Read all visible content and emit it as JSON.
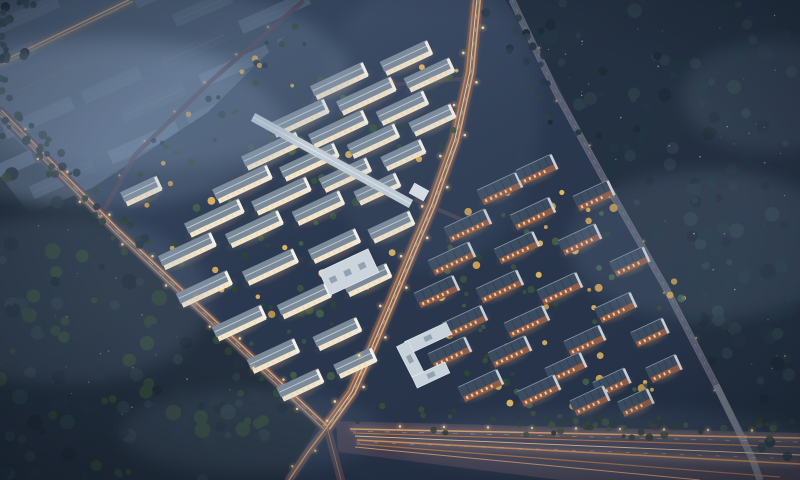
{
  "meta": {
    "title": "Night aerial rendering of residential development",
    "kind": "architectural-visualization",
    "width": 800,
    "height": 480
  },
  "colors": {
    "baseTL": "#41536c",
    "baseMid": "#2b3950",
    "baseBR": "#232e42",
    "forest1": "#263642",
    "forest2": "#1e2b37",
    "forest3": "#2d3e49",
    "forest4": "#223440",
    "forestGreen": "#2f4438",
    "indA": "#46586f",
    "indB": "#3e4e63",
    "indC": "#4e6078",
    "roadSurface": "#4c4859",
    "roadSurfaceWide": "#474354",
    "roadEdge": "#5e5a6d",
    "trailOrange": "#f2a96b",
    "trailBright": "#ffd8a4",
    "trailDeep": "#cf8349",
    "dashWhite": "#ded8cc",
    "lampCore": "#ffe2ad",
    "lampHalo": "#f5b878",
    "whiteRoof": "#7b8a99",
    "whiteRidge": "#c2cdd6",
    "whiteFacade": "#efe7d6",
    "whiteWindow": "#ffd9a0",
    "whiteEnd": "#f6f1e6",
    "darkRoof": "#3c4c60",
    "darkPanel": "#2e3c4e",
    "darkRidge": "#8494a4",
    "brick": "#8e5c48",
    "brickWindow": "#ffc890",
    "gable": "#d8dee3",
    "corridorRoof": "#c3ced7",
    "flatRoof": "#ccd5dd",
    "skylight": "#91a2b0",
    "glow": "#ffbe78",
    "fog": "#8aa0bc",
    "sparkle": "#cfd9e4",
    "treeYellow": "#d2a24f",
    "treeYellow2": "#e2b660",
    "clusterGreen": "#3a5440"
  },
  "industrial": {
    "clip": [
      [
        24,
        0
      ],
      [
        322,
        0
      ],
      [
        208,
        112
      ],
      [
        92,
        188
      ],
      [
        30,
        214
      ],
      [
        0,
        176
      ],
      [
        0,
        30
      ]
    ],
    "rotation": -24,
    "pivot": [
      150,
      80
    ],
    "rows": 8,
    "cols": 8,
    "x0": -90,
    "y0": -70,
    "dx": 86,
    "dy": 33,
    "w": 62,
    "h": 14,
    "opacity": 0.92,
    "fogPatch": [
      95,
      120,
      200,
      85,
      0.3
    ]
  },
  "roads": {
    "leftRoad": {
      "pts": [
        [
          0,
          112
        ],
        [
          118,
          232
        ],
        [
          325,
          427
        ]
      ],
      "w": 9
    },
    "mainRoad": {
      "pts": [
        [
          477,
          0
        ],
        [
          470,
          72
        ],
        [
          455,
          140
        ],
        [
          432,
          205
        ],
        [
          412,
          252
        ],
        [
          392,
          300
        ],
        [
          370,
          352
        ],
        [
          352,
          392
        ],
        [
          327,
          427
        ]
      ],
      "w": 13
    },
    "exitS": {
      "pts": [
        [
          327,
          427
        ],
        [
          341,
          480
        ]
      ],
      "w": 8
    },
    "exitSW": {
      "pts": [
        [
          327,
          427
        ],
        [
          308,
          452
        ],
        [
          289,
          480
        ]
      ],
      "w": 8
    },
    "rightRoad": {
      "pts": [
        [
          512,
          0
        ],
        [
          556,
          92
        ],
        [
          610,
          190
        ],
        [
          667,
          290
        ],
        [
          716,
          385
        ],
        [
          752,
          458
        ],
        [
          760,
          480
        ]
      ],
      "w": 5.5
    },
    "edgeRoad": {
      "pts": [
        [
          302,
          2
        ],
        [
          212,
          80
        ],
        [
          135,
          155
        ],
        [
          103,
          212
        ],
        [
          118,
          232
        ]
      ],
      "w": 4.5
    },
    "northEntry": {
      "pts": [
        [
          472,
          78
        ],
        [
          386,
          85
        ]
      ],
      "w": 4
    },
    "gateRoad": {
      "pts": [
        [
          416,
          200
        ],
        [
          467,
          222
        ]
      ],
      "w": 4
    },
    "cornerTrail": {
      "pts": [
        [
          0,
          64
        ],
        [
          132,
          0
        ]
      ],
      "w": 3
    },
    "bottomPoly": [
      [
        336,
        421
      ],
      [
        800,
        433
      ],
      [
        800,
        480
      ],
      [
        560,
        480
      ],
      [
        338,
        452
      ]
    ],
    "bottomLanes": [
      {
        "a": [
          350,
          429
        ],
        "b": [
          800,
          438
        ],
        "c": "#f2ab6e",
        "w": 1.5,
        "glow": true
      },
      {
        "a": [
          353,
          433
        ],
        "b": [
          800,
          447
        ],
        "c": "#cc8148",
        "w": 1.1
      },
      {
        "a": [
          355,
          436
        ],
        "b": [
          800,
          455
        ],
        "c": "#ffd8a4",
        "w": 0.9
      },
      {
        "a": [
          357,
          440
        ],
        "b": [
          800,
          464
        ],
        "c": "#e89a5c",
        "w": 1.5,
        "glow": true
      },
      {
        "a": [
          357,
          444
        ],
        "b": [
          780,
          477
        ],
        "c": "#c07a45",
        "w": 1.2
      },
      {
        "a": [
          355,
          447
        ],
        "b": [
          700,
          480
        ],
        "c": "#e8a76a",
        "w": 1.0
      },
      {
        "a": [
          351,
          431
        ],
        "b": [
          800,
          442
        ],
        "c": "#ded8cc",
        "w": 0.6,
        "dash": "5 12"
      },
      {
        "a": [
          356,
          442
        ],
        "b": [
          800,
          459
        ],
        "c": "#d8d2c6",
        "w": 0.6,
        "dash": "4 14"
      }
    ]
  },
  "clusters": {
    "left": {
      "angle": -25,
      "buildings": [
        [
          340,
          82,
          58
        ],
        [
          407,
          59,
          52
        ],
        [
          300,
          119,
          60
        ],
        [
          367,
          97,
          60
        ],
        [
          430,
          76,
          50
        ],
        [
          272,
          152,
          60
        ],
        [
          339,
          130,
          60
        ],
        [
          403,
          109,
          52
        ],
        [
          243,
          185,
          60
        ],
        [
          310,
          163,
          60
        ],
        [
          374,
          142,
          52
        ],
        [
          433,
          121,
          46
        ],
        [
          215,
          219,
          60
        ],
        [
          282,
          197,
          60
        ],
        [
          346,
          176,
          52
        ],
        [
          404,
          156,
          44
        ],
        [
          188,
          252,
          58
        ],
        [
          255,
          230,
          58
        ],
        [
          319,
          209,
          52
        ],
        [
          378,
          190,
          46
        ],
        [
          205,
          290,
          56
        ],
        [
          271,
          268,
          56
        ],
        [
          335,
          247,
          52
        ],
        [
          392,
          228,
          46
        ],
        [
          240,
          324,
          54
        ],
        [
          305,
          302,
          54
        ],
        [
          368,
          281,
          48
        ],
        [
          274,
          357,
          52
        ],
        [
          338,
          335,
          48
        ],
        [
          301,
          386,
          46
        ],
        [
          356,
          364,
          42
        ],
        [
          142,
          192,
          40
        ],
        [
          152,
          197,
          0
        ]
      ]
    },
    "right": {
      "angle": -25,
      "buildings": [
        [
          500,
          189,
          44
        ],
        [
          537,
          170,
          40
        ],
        [
          468,
          226,
          46
        ],
        [
          533,
          214,
          44
        ],
        [
          594,
          196,
          40
        ],
        [
          452,
          259,
          46
        ],
        [
          517,
          248,
          44
        ],
        [
          580,
          240,
          42
        ],
        [
          630,
          262,
          38
        ],
        [
          437,
          292,
          44
        ],
        [
          500,
          287,
          46
        ],
        [
          560,
          289,
          44
        ],
        [
          616,
          308,
          40
        ],
        [
          650,
          333,
          36
        ],
        [
          465,
          322,
          44
        ],
        [
          527,
          322,
          44
        ],
        [
          585,
          341,
          40
        ],
        [
          664,
          369,
          34
        ],
        [
          450,
          353,
          42
        ],
        [
          510,
          352,
          42
        ],
        [
          566,
          368,
          40
        ],
        [
          612,
          383,
          36
        ],
        [
          481,
          386,
          44
        ],
        [
          539,
          391,
          42
        ],
        [
          590,
          401,
          38
        ],
        [
          636,
          403,
          34
        ]
      ]
    },
    "corridor": {
      "a": [
        253,
        117
      ],
      "b": [
        411,
        204
      ],
      "w": 9
    },
    "gate": {
      "cx": 419,
      "cy": 192,
      "w": 17,
      "h": 12,
      "rot": 29
    },
    "bigFlat": {
      "cx": 349,
      "cy": 272,
      "w": 54,
      "h": 26,
      "rot": -25
    },
    "uBuilding": [
      {
        "cx": 428,
        "cy": 338,
        "w": 46,
        "h": 13,
        "rot": -25
      },
      {
        "cx": 410,
        "cy": 359,
        "w": 34,
        "h": 13,
        "rot": 63
      },
      {
        "cx": 431,
        "cy": 375,
        "w": 36,
        "h": 12,
        "rot": -25
      }
    ]
  },
  "forests": [
    {
      "name": "top-right",
      "poly": [
        [
          505,
          0
        ],
        [
          800,
          0
        ],
        [
          800,
          468
        ],
        [
          772,
          468
        ],
        [
          700,
          340
        ],
        [
          610,
          165
        ],
        [
          540,
          55
        ]
      ],
      "n": 130,
      "pal": [
        "#263642",
        "#1e2b37",
        "#2d3e49",
        "#223440"
      ],
      "r": [
        3,
        8
      ],
      "seed": 7
    },
    {
      "name": "mid-gap",
      "poly": [
        [
          480,
          8
        ],
        [
          514,
          4
        ],
        [
          602,
          170
        ],
        [
          548,
          122
        ]
      ],
      "n": 18,
      "pal": [
        "#263642",
        "#1e2b37",
        "#2d3e49"
      ],
      "r": [
        2.5,
        5
      ],
      "seed": 11
    },
    {
      "name": "left",
      "poly": [
        [
          0,
          132
        ],
        [
          70,
          205
        ],
        [
          300,
          408
        ],
        [
          268,
          480
        ],
        [
          0,
          480
        ]
      ],
      "n": 115,
      "pal": [
        "#243240",
        "#1d2a36",
        "#2b3c46",
        "#2f4438"
      ],
      "r": [
        3,
        8
      ],
      "seed": 13
    },
    {
      "name": "top-left-corner",
      "poly": [
        [
          0,
          0
        ],
        [
          46,
          0
        ],
        [
          24,
          64
        ],
        [
          0,
          96
        ]
      ],
      "n": 22,
      "pal": [
        "#263642",
        "#1e2b37",
        "#2d3e49"
      ],
      "r": [
        2.5,
        5
      ],
      "seed": 17
    },
    {
      "name": "left-road-line",
      "poly": [
        [
          0,
          88
        ],
        [
          150,
          242
        ],
        [
          122,
          262
        ],
        [
          0,
          118
        ]
      ],
      "n": 42,
      "pal": [
        "#2c3c42",
        "#223440",
        "#2f4438"
      ],
      "r": [
        2,
        4.5
      ],
      "seed": 19
    },
    {
      "name": "bottom-strip",
      "poly": [
        [
          356,
          404
        ],
        [
          795,
          421
        ],
        [
          795,
          442
        ],
        [
          352,
          431
        ]
      ],
      "n": 58,
      "pal": [
        "#2e3d33",
        "#27352c",
        "#3a4a3a"
      ],
      "r": [
        2,
        4
      ],
      "seed": 23
    },
    {
      "name": "left-cluster-green",
      "poly": [
        [
          160,
          256
        ],
        [
          300,
          62
        ],
        [
          468,
          40
        ],
        [
          452,
          150
        ],
        [
          330,
          392
        ],
        [
          252,
          392
        ]
      ],
      "n": 95,
      "pal": [
        "#3a5440",
        "#2e4635",
        "#d2a24f",
        "#e2b660",
        "#43604a"
      ],
      "r": [
        1.8,
        4.2
      ],
      "seed": 29
    },
    {
      "name": "right-cluster-green",
      "poly": [
        [
          448,
          206
        ],
        [
          545,
          160
        ],
        [
          648,
          228
        ],
        [
          688,
          305
        ],
        [
          664,
          400
        ],
        [
          470,
          413
        ],
        [
          428,
          300
        ]
      ],
      "n": 85,
      "pal": [
        "#3a5440",
        "#2e4635",
        "#d2a24f",
        "#e2b660",
        "#43604a"
      ],
      "r": [
        1.8,
        4.2
      ],
      "seed": 31
    },
    {
      "name": "edge-road-green",
      "poly": [
        [
          120,
          170
        ],
        [
          290,
          20
        ],
        [
          318,
          30
        ],
        [
          150,
          212
        ]
      ],
      "n": 30,
      "pal": [
        "#2c4233",
        "#223440",
        "#d2a24f"
      ],
      "r": [
        1.8,
        3.8
      ],
      "seed": 37
    }
  ],
  "sparkleRegions": [
    {
      "poly": [
        [
          540,
          40
        ],
        [
          790,
          10
        ],
        [
          790,
          440
        ],
        [
          700,
          330
        ]
      ],
      "n": 40,
      "seed": 41
    },
    {
      "poly": [
        [
          20,
          180
        ],
        [
          250,
          400
        ],
        [
          60,
          440
        ]
      ],
      "n": 22,
      "seed": 43
    }
  ],
  "fogPatches": [
    [
      140,
      78,
      210,
      92,
      0.22
    ],
    [
      60,
      300,
      150,
      85,
      0.15
    ],
    [
      250,
      432,
      130,
      42,
      0.12
    ],
    [
      708,
      245,
      140,
      75,
      0.15
    ],
    [
      610,
      443,
      210,
      34,
      0.12
    ],
    [
      772,
      96,
      90,
      56,
      0.13
    ],
    [
      95,
      128,
      190,
      80,
      0.22
    ],
    [
      430,
      120,
      110,
      150,
      0.08
    ]
  ],
  "streetlights": [
    {
      "road": "mainRoad",
      "spacing": 27,
      "offset": 8.5,
      "alt": true,
      "r": 1.3,
      "op": 0.95
    },
    {
      "road": "leftRoad",
      "spacing": 30,
      "offset": 6,
      "alt": true,
      "r": 1.2,
      "op": 0.9
    },
    {
      "road": "rightRoad",
      "spacing": 55,
      "offset": 4,
      "alt": true,
      "r": 0.9,
      "op": 0.5
    },
    {
      "road": "edgeRoad",
      "spacing": 42,
      "offset": 3.5,
      "alt": false,
      "r": 0.9,
      "op": 0.55
    },
    {
      "road": "northEntry",
      "spacing": 40,
      "offset": 3,
      "alt": false,
      "r": 1.0,
      "op": 0.8
    },
    {
      "road": "exitSW",
      "spacing": 26,
      "offset": 5,
      "alt": true,
      "r": 1.1,
      "op": 0.8
    }
  ],
  "bottomEdgeLights": {
    "a": [
      356,
      426
    ],
    "b": [
      795,
      431
    ],
    "spacing": 44,
    "r": 1.2
  }
}
